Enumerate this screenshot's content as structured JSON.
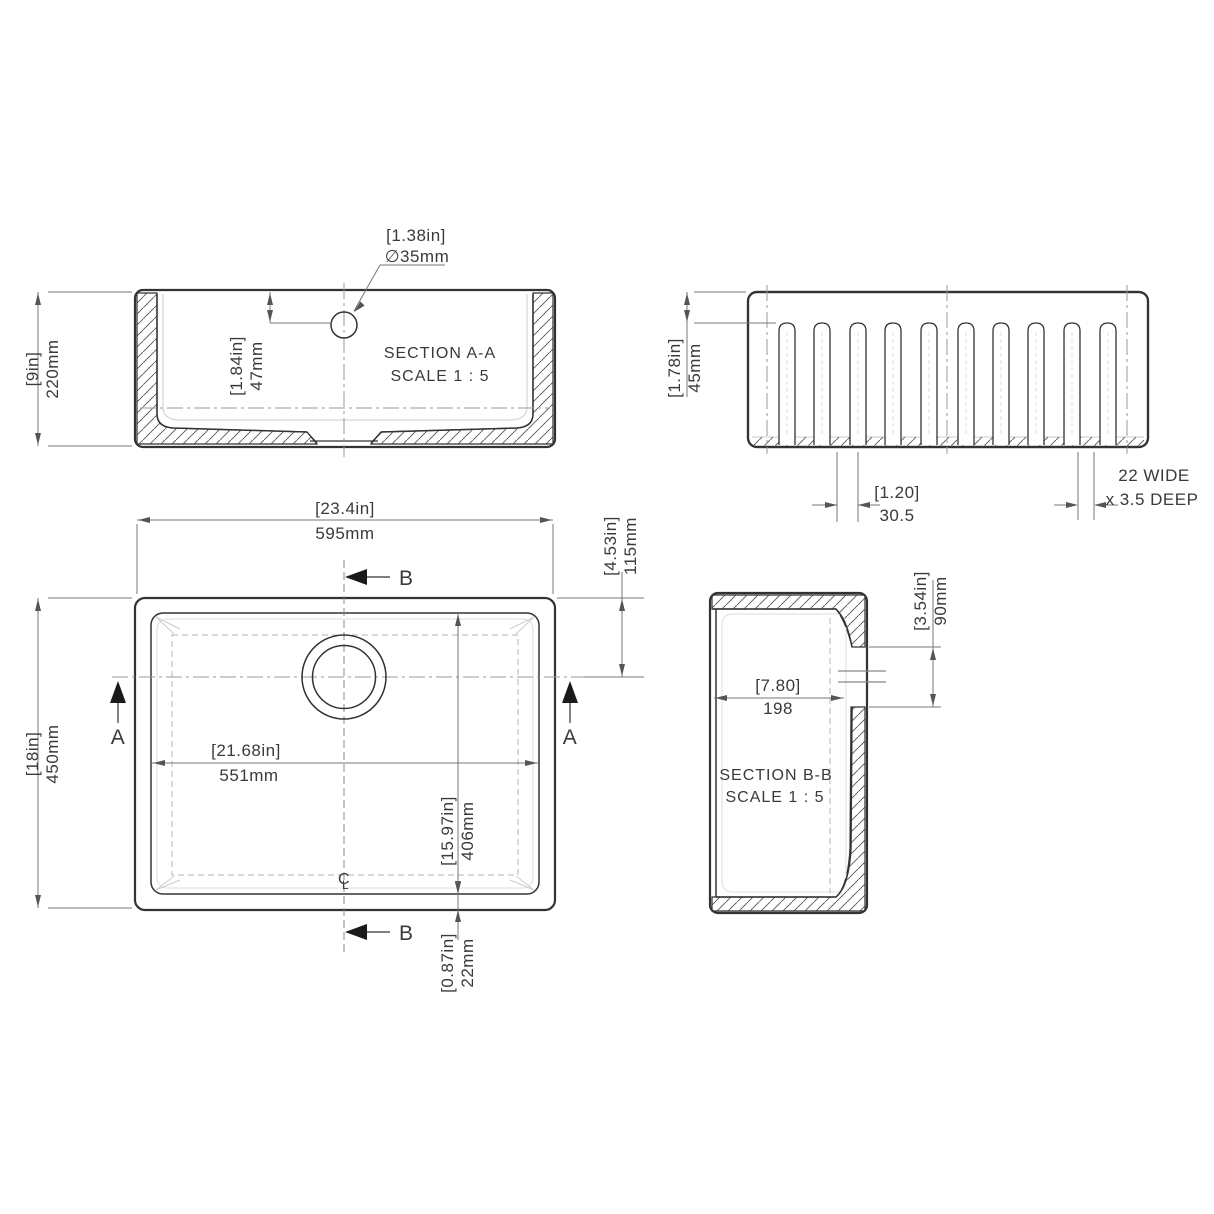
{
  "aa": {
    "title": "SECTION A-A",
    "scale": "SCALE 1 : 5",
    "dia_in": "[1.38in]",
    "dia_mm": "∅35mm",
    "h_in": "[9in]",
    "h_mm": "220mm",
    "d_in": "[1.84in]",
    "d_mm": "47mm"
  },
  "front": {
    "t_in": "[1.78in]",
    "t_mm": "45mm",
    "p_in": "[1.20]",
    "p_mm": "30.5",
    "note1": "22 WIDE",
    "note2": "x 3.5 DEEP"
  },
  "plan": {
    "w_in": "[23.4in]",
    "w_mm": "595mm",
    "d_in": "[18in]",
    "d_mm": "450mm",
    "iw_in": "[21.68in]",
    "iw_mm": "551mm",
    "id_in": "[15.97in]",
    "id_mm": "406mm",
    "off_in": "[4.53in]",
    "off_mm": "115mm",
    "wall_in": "[0.87in]",
    "wall_mm": "22mm",
    "a": "A",
    "b": "B",
    "cl_c": "C",
    "cl_l": "L"
  },
  "bb": {
    "title": "SECTION B-B",
    "scale": "SCALE 1 : 5",
    "w_in": "[7.80]",
    "w_mm": "198",
    "h_in": "[3.54in]",
    "h_mm": "90mm"
  }
}
